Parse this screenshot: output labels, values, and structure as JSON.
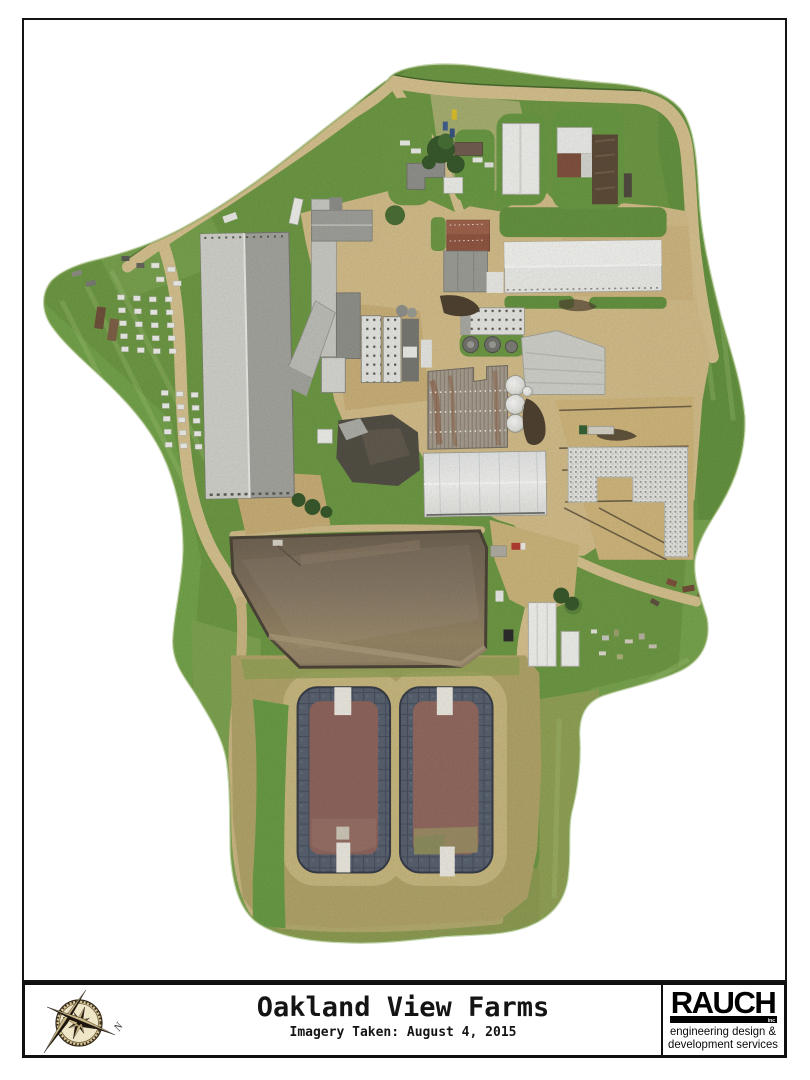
{
  "title_block": {
    "title": "Oakland View Farms",
    "subtitle": "Imagery Taken: August 4, 2015"
  },
  "compass": {
    "north_label": "N"
  },
  "logo": {
    "company": "RAUCH",
    "suffix": "inc",
    "tagline_line1": "engineering design &",
    "tagline_line2": "development services"
  },
  "map": {
    "type": "aerial-orthophoto",
    "visible_features": [
      "farm-boundary-orthomosaic-blob",
      "dirt-roads",
      "grass-fields",
      "large-gray-freestall-barn",
      "long-white-barn-north",
      "long-white-barn-center",
      "feed-mill-complex",
      "corrugated-machine-shed",
      "rusty-red-roof-barn",
      "white-sheds-north",
      "calf-hutch-rows",
      "grain-silos",
      "round-feed-tanks",
      "gravel-stockpile",
      "feed-lanes",
      "earthen-manure-lagoon",
      "lined-lagoon-cell-west",
      "lined-lagoon-cell-east",
      "concrete-ramps",
      "white-sheds-southeast",
      "farmhouse",
      "trees",
      "vehicles"
    ]
  },
  "colors": {
    "page_bg": "#ffffff",
    "frame": "#141414",
    "grass": "#68963c",
    "grass_light": "#7fae4e",
    "grass_dark": "#4d7a2c",
    "hedge": "#38591f",
    "olive_berm": "#b1a364",
    "road_tan": "#d8c28c",
    "dirt": "#c9ad72",
    "lagoon_brown": "#7e6e58",
    "lagoon_rim": "#453c2e",
    "liner_gray": "#525b6b",
    "cell_liquid": "#8b5f57",
    "building_white": "#f3f3f0",
    "building_gray": "#9c9c98",
    "rust": "#8a5138",
    "gravel": "#e8e8e4",
    "compass_tan": "#d9c695",
    "logo_black": "#000000"
  }
}
